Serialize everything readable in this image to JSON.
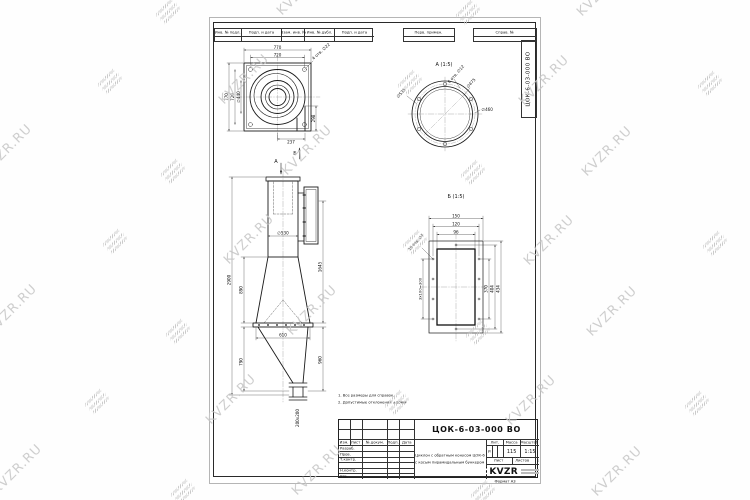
{
  "watermark": {
    "text": "KVZR.RU"
  },
  "frame": {
    "top_cells": [
      "Инв. № подл.",
      "Подп. и дата",
      "Взам. инв. №",
      "Инв. № дубл.",
      "Подп. и дата"
    ],
    "top_right_cells": [
      "Перв. примен.",
      "Справ. №"
    ],
    "side_doc_number": "ЦОК-6-03-000 ВО",
    "format_note": "Формат А3"
  },
  "drawing": {
    "top_view": {
      "dim_width_outer": "770",
      "dim_width_bolt": "720",
      "dim_height_outer": "770",
      "dim_height_bolt": "720",
      "dim_inner_dia": "∅440",
      "dim_outlet_h": "298",
      "dim_outlet_w": "237",
      "note_holes": "4 отв. ∅22",
      "arrow_a": "А",
      "arrow_b": "Б"
    },
    "front_view": {
      "dim_total_h": "2900",
      "dim_cone_h": "890",
      "dim_bunker_h": "790",
      "dim_right_h": "1645",
      "dim_bunker_right_h": "960",
      "dim_body_dia": "∅530",
      "dim_flange_w": "610",
      "dim_outlet": "200х200"
    },
    "view_a": {
      "title": "А (1:5)",
      "dim_outer": "∅535",
      "dim_mid": "∅475",
      "dim_inner": "∅460",
      "note_holes": "6 отв. ∅12"
    },
    "view_b": {
      "title": "Б (1:5)",
      "dim_w1": "150",
      "dim_w2": "120",
      "dim_w3": "96",
      "dim_h1": "370",
      "dim_h2": "404",
      "dim_h3": "434",
      "dim_spacing": "3х100=300",
      "note_holes": "10 отв. ∅7"
    },
    "notes": {
      "line1": "1. Все размеры для справок.",
      "line2": "2. Допустимые отклонения ±10мм"
    }
  },
  "title_block": {
    "doc_number": "ЦОК-6-03-000 ВО",
    "rev_header": [
      "Изм.",
      "Лист",
      "№ докум.",
      "Подп.",
      "Дата"
    ],
    "role_rows": [
      "Разраб.",
      "Пров.",
      "Т.контр.",
      "",
      "Н.контр.",
      "Утв."
    ],
    "product_line1": "Циклон с обратным конусом ЦОК-6",
    "product_line2": "с косым пирамидальным бункером",
    "lit_label": "Лит.",
    "lit_value": "И",
    "mass_label": "Масса",
    "mass_value": "115",
    "scale_label": "Масштаб",
    "scale_value": "1:15",
    "sheet_label": "Лист",
    "sheets_label": "Листов",
    "sheets_value": "1",
    "company_logo": "KVZR"
  }
}
